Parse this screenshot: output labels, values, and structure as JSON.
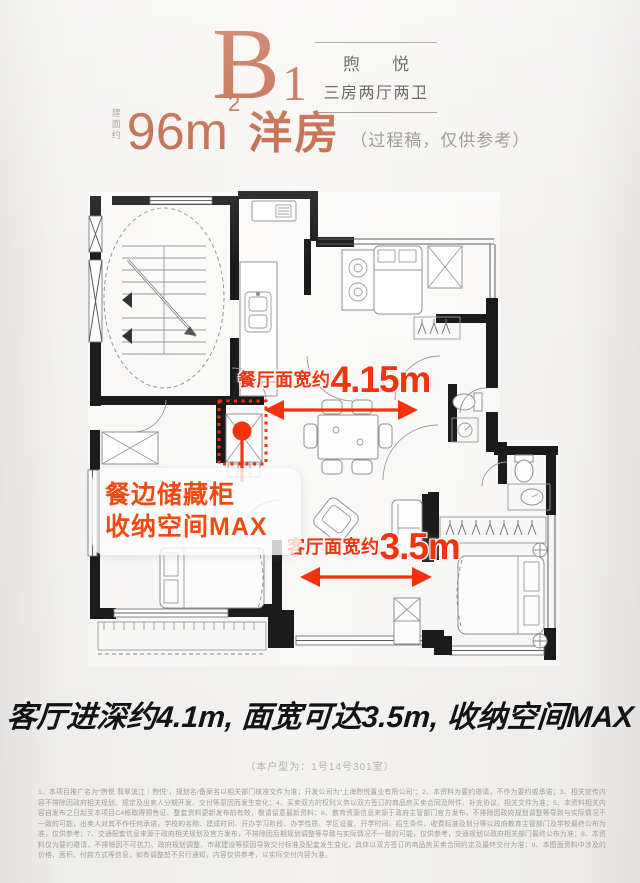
{
  "header": {
    "plan_letter": "B",
    "plan_number": "1",
    "brand_name": "煦 悦",
    "layout_type": "三房两厅两卫",
    "area_prefix": "建面约",
    "area_value": "96m",
    "area_sup": "2",
    "product_type": "洋房",
    "note": "（过程稿，仅供参考）"
  },
  "annotations": {
    "dining_width": {
      "label": "餐厅面宽约",
      "value": "4.15m"
    },
    "living_width": {
      "label": "客厅面宽约",
      "value": "3.5m"
    },
    "callout_line1": "餐边储藏柜",
    "callout_line2": "收纳空间MAX"
  },
  "footer": {
    "headline": "客厅进深约4.1m, 面宽可达3.5m, 收纳空间MAX",
    "unit_note": "（本户型为：1号14号301室）",
    "disclaimer": "1、本项目推广名为“煦悦 翡翠滨江｜煦悦”，规划名/备案名以相关部门核准文件为准；开发公司为“上海煦悦置业有限公司”；2、本资料为要约邀请，不作为要约或承诺；3、相关宣传内容不排除因政府相关规划、规定及出卖人分期开发、交付等原因而发生变化；4、买卖双方的权利义务以双方签订的商品房买卖合同及附件、补充协议、相关文件为准；5、本资料相关内容自发布之日起至本项目C4栋取得预售证、整套资料更新发布前有效，敬请留意最新资料；6、教育资源信息来源于政府主管部门官方发布，不排除因政府规划调整等导致与实际情况不一致的可能，出卖人对其不作任何承诺，学校的名称、建成时间、开办学习阶段、办学性质、学区设置、开学时间、招生条件、收费标准及划分等以政府教育主管部门及学校最终公布为准，仅供参考；7、交通配套信息来源于政府相关规划及官方发布，不排除因后期规划调整等导致与实际情况不一致的可能，仅供参考，交通规划以政府相关部门最终公布为准；8、本资料仅为要约邀请，不排除因不可抗力、政府规划调整、市政建设等原因导致交付标准及配套发生变化，具体以双方签订的商品房买卖合同约定及最终交付为准；9、本图面资料中涉及的价格、面积、付款方式等信息，如有调整恕不另行通知，内容仅供参考，以实际交付内容为准。"
  },
  "colors": {
    "accent": "#bd5936",
    "annotation_red": "#f5320e"
  }
}
